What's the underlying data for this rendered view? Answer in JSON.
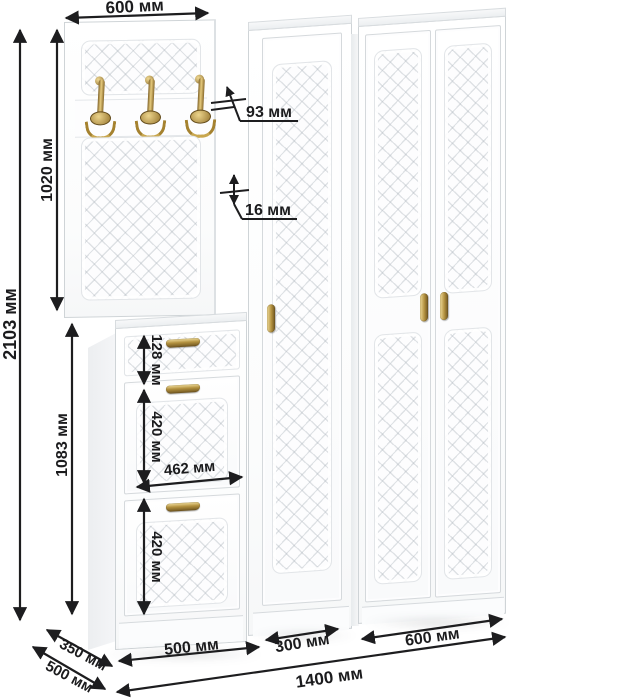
{
  "dimensions": {
    "panel_width_top": "600 мм",
    "total_height": "2103 мм",
    "panel_height": "1020 мм",
    "hook_offset": "93 мм",
    "panel_thickness": "16 мм",
    "shoe_cabinet_height": "1083 мм",
    "drawer_height": "128 мм",
    "compartment_top_height": "420 мм",
    "compartment_inner_width": "462 мм",
    "compartment_bottom_height": "420 мм",
    "shoe_cabinet_width": "500 мм",
    "middle_wardrobe_width": "300 мм",
    "right_wardrobe_width": "600 мм",
    "total_width": "1400 мм",
    "depth_shoe_cabinet": "350 мм",
    "depth_total": "500 мм"
  },
  "colors": {
    "dimension_line": "#1d1d1f",
    "furniture": "#ffffff",
    "outline": "#cfd4d7",
    "brass": "#b3913f"
  }
}
